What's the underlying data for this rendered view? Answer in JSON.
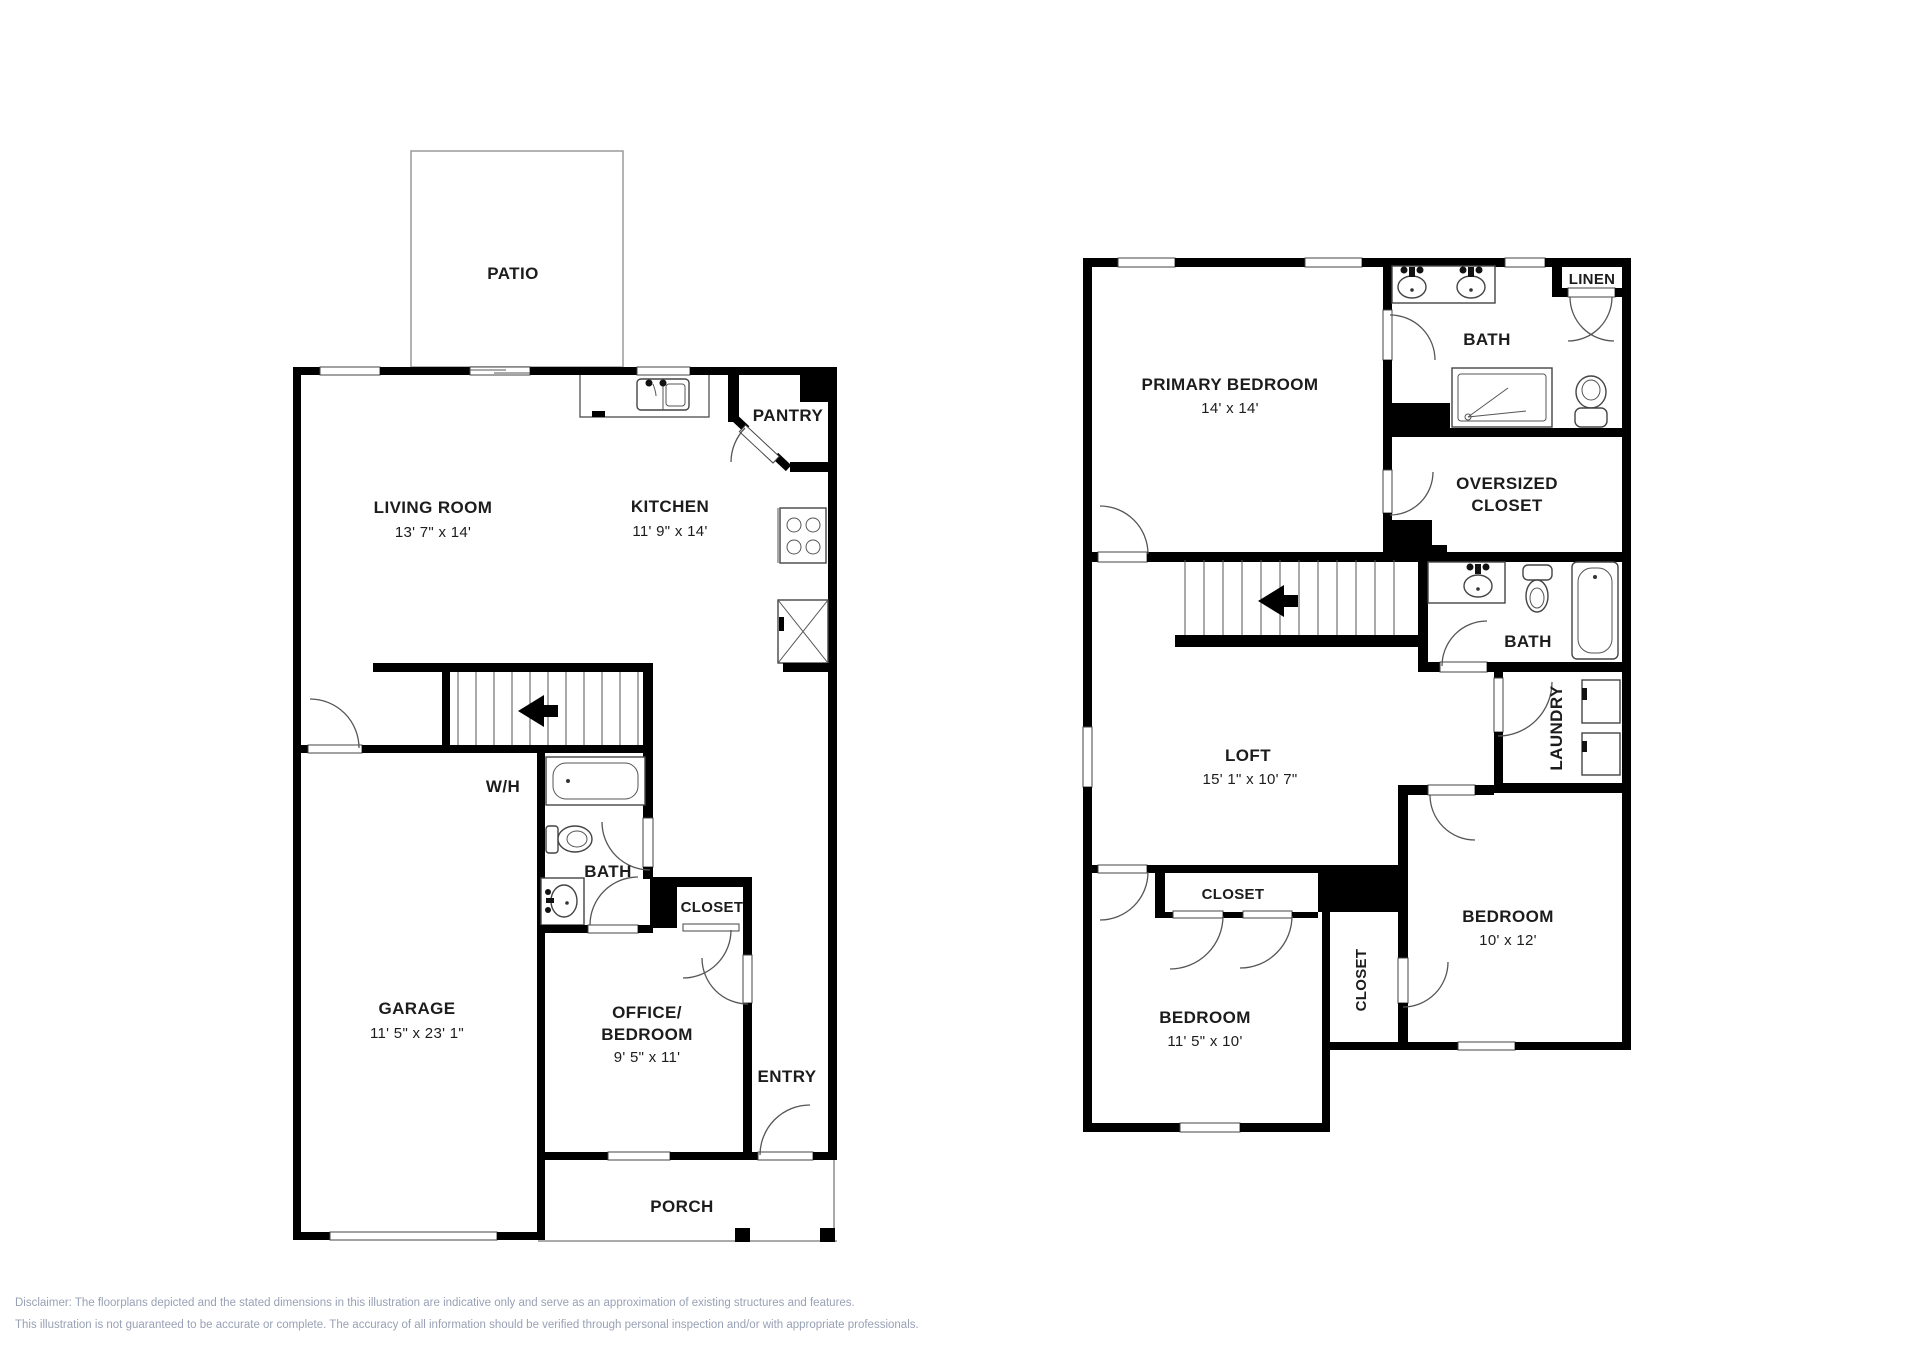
{
  "floor1": {
    "patio": "PATIO",
    "living_room": {
      "name": "LIVING ROOM",
      "dims": "13' 7\" x 14'"
    },
    "kitchen": {
      "name": "KITCHEN",
      "dims": "11' 9\" x 14'"
    },
    "pantry": "PANTRY",
    "water_heater": "W/H",
    "bath": "BATH",
    "closet": "CLOSET",
    "office": {
      "line1": "OFFICE/",
      "line2": "BEDROOM",
      "dims": "9' 5\" x 11'"
    },
    "entry": "ENTRY",
    "garage": {
      "name": "GARAGE",
      "dims": "11' 5\" x 23' 1\""
    },
    "porch": "PORCH"
  },
  "floor2": {
    "primary_bedroom": {
      "name": "PRIMARY BEDROOM",
      "dims": "14' x 14'"
    },
    "bath_primary": "BATH",
    "linen": "LINEN",
    "oversized_closet": {
      "line1": "OVERSIZED",
      "line2": "CLOSET"
    },
    "bath_hall": "BATH",
    "laundry": "LAUNDRY",
    "loft": {
      "name": "LOFT",
      "dims": "15' 1\" x 10' 7\""
    },
    "closet_bedroom1": "CLOSET",
    "closet_hall": "CLOSET",
    "bedroom1": {
      "name": "BEDROOM",
      "dims": "11' 5\" x 10'"
    },
    "bedroom2": {
      "name": "BEDROOM",
      "dims": "10' x 12'"
    }
  },
  "disclaimer": {
    "line1": "Disclaimer: The floorplans depicted and the stated dimensions in this illustration are indicative only and serve as an approximation of existing structures and features.",
    "line2": "This illustration is not guaranteed to be accurate or complete. The accuracy of all information should be verified through personal inspection and/or with appropriate professionals."
  }
}
